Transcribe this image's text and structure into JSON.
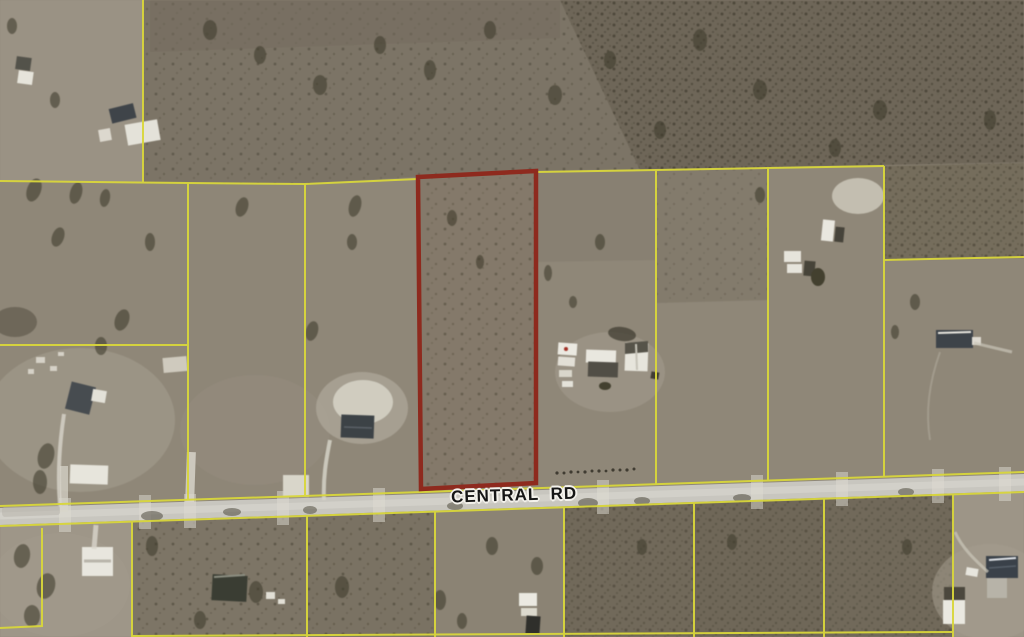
{
  "map": {
    "road": {
      "label": "CENTRAL RD"
    },
    "colors": {
      "parcel_line": "#d9d63b",
      "highlight_outline": "#8e2a1e",
      "road_surface": "#c8c6bf"
    }
  }
}
